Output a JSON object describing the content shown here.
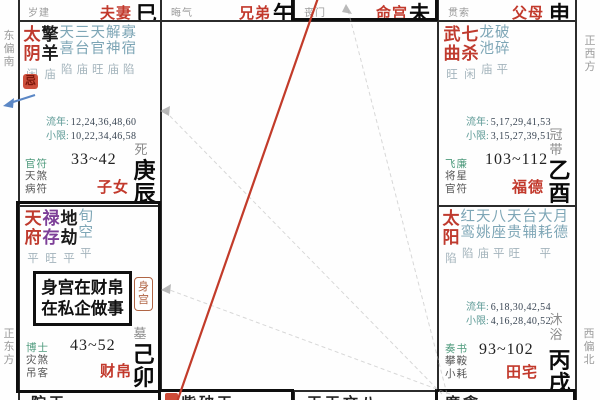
{
  "labels": {
    "liunian": "流年:",
    "xiaoxian": "小限:"
  },
  "directions": {
    "left_top": "东偏南",
    "left_bottom": "正东方",
    "right_top": "正西方",
    "right_bottom": "西偏北"
  },
  "top_row": [
    {
      "god": "岁建",
      "palace": "夫妻",
      "branch": "巳"
    },
    {
      "god": "晦气",
      "palace": "兄弟",
      "branch": "午"
    },
    {
      "god": "丧门",
      "palace": "命宫",
      "branch": "未"
    },
    {
      "god": "贯索",
      "palace": "父母",
      "branch": "申"
    }
  ],
  "palaces": {
    "chen": {
      "stars": [
        {
          "name": "太阴",
          "status": "闲",
          "type": "main"
        },
        {
          "name": "擎羊",
          "status": "庙",
          "type": "malefic"
        },
        {
          "name": "天喜",
          "status": "陷",
          "type": "minor"
        },
        {
          "name": "三台",
          "status": "庙",
          "type": "minor"
        },
        {
          "name": "天官",
          "status": "旺",
          "type": "minor"
        },
        {
          "name": "解神",
          "status": "庙",
          "type": "minor"
        },
        {
          "name": "寡宿",
          "status": "陷",
          "type": "minor"
        }
      ],
      "marker": "忌",
      "liunian": "12,24,36,48,60",
      "xiaoxian": "10,22,34,46,58",
      "age": "33~42",
      "stage": "死",
      "gods": [
        "官符",
        "天煞",
        "病符"
      ],
      "palace_name": "子女",
      "branch": "庚辰"
    },
    "you": {
      "stars": [
        {
          "name": "武曲",
          "status": "旺",
          "type": "main"
        },
        {
          "name": "七杀",
          "status": "闲",
          "type": "main"
        },
        {
          "name": "龙池",
          "status": "庙",
          "type": "minor"
        },
        {
          "name": "破碎",
          "status": "平",
          "type": "minor"
        }
      ],
      "liunian": "5,17,29,41,53",
      "xiaoxian": "3,15,27,39,51",
      "age": "103~112",
      "stage": "冠带",
      "gods": [
        "飞廉",
        "将星",
        "官符"
      ],
      "palace_name": "福德",
      "branch": "乙酉"
    },
    "mao": {
      "stars": [
        {
          "name": "天府",
          "status": "平",
          "type": "main"
        },
        {
          "name": "禄存",
          "status": "旺",
          "type": "lucun"
        },
        {
          "name": "地劫",
          "status": "平",
          "type": "malefic"
        },
        {
          "name": "旬空",
          "status": "平",
          "type": "minor"
        }
      ],
      "age": "43~52",
      "stage": "墓",
      "gods": [
        "博士",
        "灾煞",
        "吊客"
      ],
      "palace_name": "财帛",
      "branch": "己卯"
    },
    "xu": {
      "stars": [
        {
          "name": "太阳",
          "status": "陷",
          "type": "main"
        },
        {
          "name": "红鸾",
          "status": "陷",
          "type": "minor"
        },
        {
          "name": "天姚",
          "status": "庙",
          "type": "minor"
        },
        {
          "name": "八座",
          "status": "平",
          "type": "minor"
        },
        {
          "name": "天贵",
          "status": "旺",
          "type": "minor"
        },
        {
          "name": "台辅",
          "status": "",
          "type": "minor"
        },
        {
          "name": "大耗",
          "status": "平",
          "type": "minor"
        },
        {
          "name": "月德",
          "status": "",
          "type": "minor"
        }
      ],
      "liunian": "6,18,30,42,54",
      "xiaoxian": "4,16,28,40,52",
      "age": "93~102",
      "stage": "沐浴",
      "gods": [
        "奏书",
        "攀鞍",
        "小耗"
      ],
      "palace_name": "田宅",
      "branch": "丙戌"
    }
  },
  "annotation": {
    "line1": "身宫在财帛",
    "line2": "在私企做事",
    "badge": "身宫"
  },
  "bottom_row": [
    {
      "stars": "陀天"
    },
    {
      "stars": "紫破天",
      "has_marker": true
    },
    {
      "stars": "天天文八"
    },
    {
      "stars": "廉贪"
    }
  ],
  "colors": {
    "main_star_red": "#bf3a2e",
    "palace_name_red": "#c2392c",
    "minor_star_teal": "#7ea6b6",
    "lucun_purple": "#7d3f98",
    "status_gray": "#a4b4bc",
    "hua_ji_red": "#cd4f3c",
    "life_line_red": "#c23b2a",
    "arrow_blue": "#5b87c5"
  }
}
